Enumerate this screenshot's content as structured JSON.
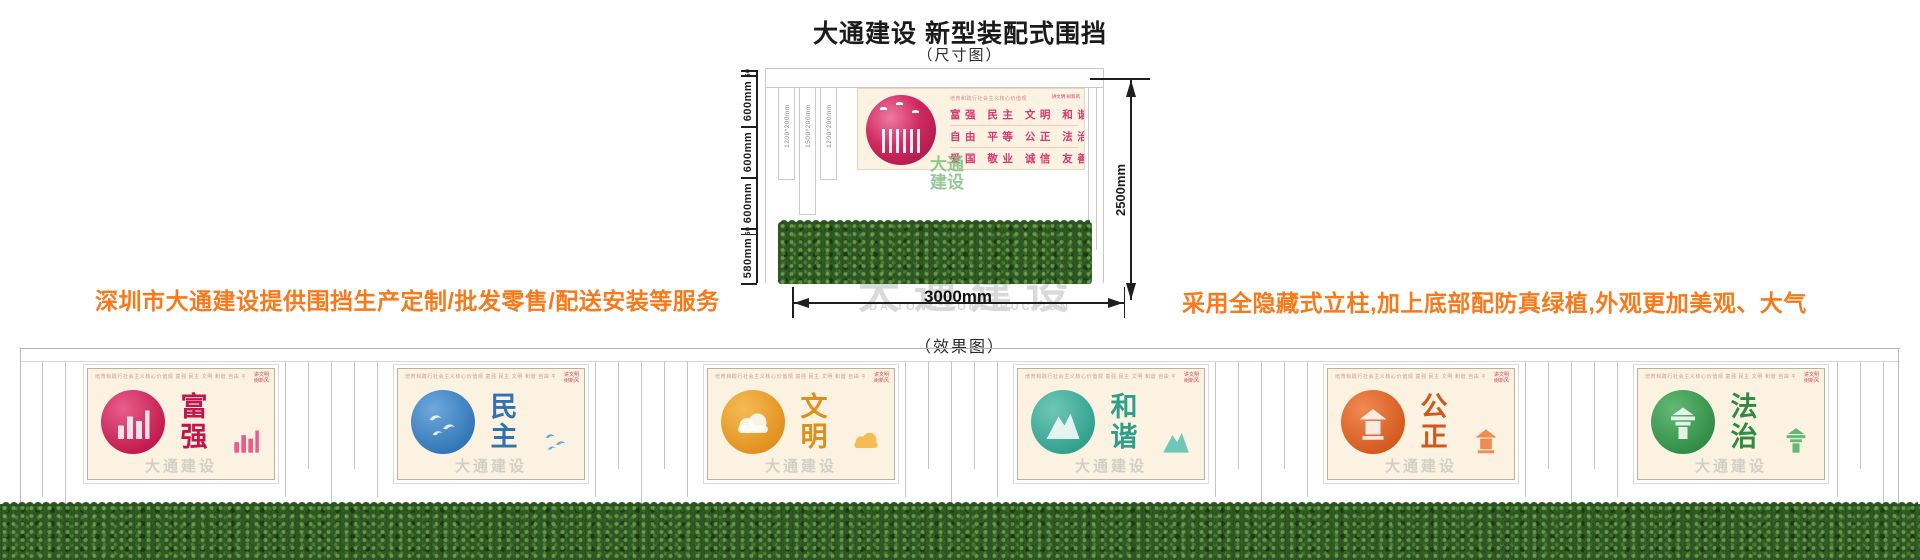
{
  "page": {
    "title": "大通建设 新型装配式围挡",
    "dimension_caption": "（尺寸图）",
    "effect_caption": "（效果图）",
    "left_note": "深圳市大通建设提供围挡生产定制/批发零售/配送安装等服务",
    "right_note": "采用全隐藏式立柱,加上底部配防真绿植,外观更加美观、大气"
  },
  "colors": {
    "note_orange": "#F8791A",
    "dimension_black": "#1E1E1E",
    "banner_cream": "#FBF2E2",
    "values_pink": "#D6386F",
    "watermark_gray": "#D9D9D9",
    "watermark_green": "#7CB97D",
    "grass_green": "#2A5220"
  },
  "dimension_diagram": {
    "vertical_segments": [
      {
        "label": "60",
        "mm": 60
      },
      {
        "label": "600mm",
        "mm": 600
      },
      {
        "label": "600mm",
        "mm": 600
      },
      {
        "label": "600mm",
        "mm": 600
      },
      {
        "label": "60",
        "mm": 60
      },
      {
        "label": "580mm",
        "mm": 580
      }
    ],
    "post_labels": [
      "1200*200mm",
      "1500*200mm",
      "1200*200mm"
    ],
    "total_height": "2500mm",
    "total_width": "3000mm",
    "banner": {
      "slogan": "培育和践行社会主义核心价值观",
      "value_rows": [
        "富强  民主  文明  和谐",
        "自由  平等  公正  法治",
        "爱国  敬业  诚信  友善"
      ],
      "corner_mark_lines": [
        "讲文明",
        "树新风"
      ]
    },
    "watermark_lines": [
      "大通",
      "建设"
    ]
  },
  "watermark": {
    "cn": "大通建设",
    "en": "DA TONG CONSTRUCTION"
  },
  "effect_view": {
    "panel_watermark": "大通建设",
    "top_strip_text": "培育和践行社会主义核心价值观  富强 民主 文明 和谐 自由 平等 公正 法治 爱国 敬业 诚信 友善",
    "corner_mark": [
      "讲文明",
      "树新风"
    ],
    "panels": [
      {
        "word": "富强",
        "color": "#C2154B",
        "color_light": "#E75E8C",
        "motif": "bar-chart"
      },
      {
        "word": "民主",
        "color": "#2E74B5",
        "color_light": "#6FA8DC",
        "motif": "doves"
      },
      {
        "word": "文明",
        "color": "#E08E1B",
        "color_light": "#F3BC55",
        "motif": "clouds"
      },
      {
        "word": "和谐",
        "color": "#2F9E8C",
        "color_light": "#6FC7B6",
        "motif": "mountains"
      },
      {
        "word": "公正",
        "color": "#D2571C",
        "color_light": "#F08A50",
        "motif": "lantern"
      },
      {
        "word": "法治",
        "color": "#2E8B43",
        "color_light": "#63B974",
        "motif": "pagoda"
      }
    ]
  }
}
